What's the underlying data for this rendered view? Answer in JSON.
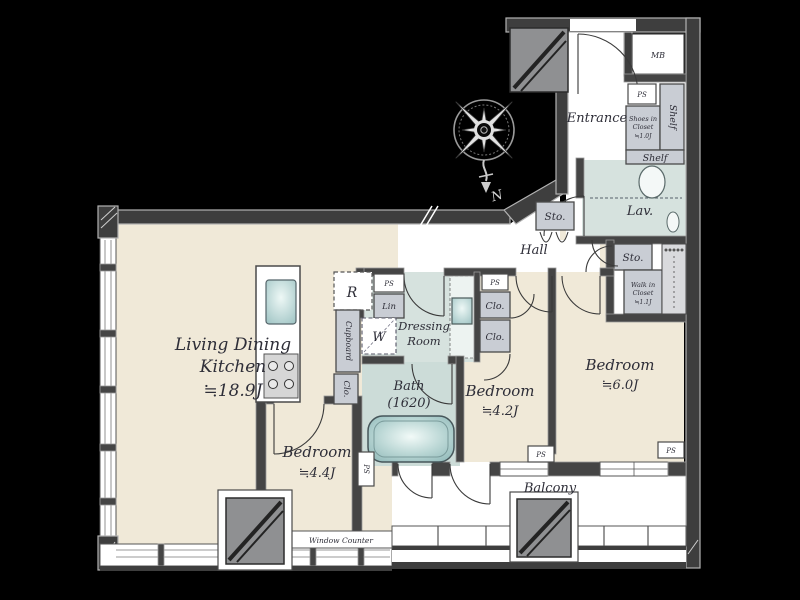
{
  "plan": {
    "title": "apartment-floor-plan",
    "rooms": {
      "ldk": {
        "line1": "Living Dining",
        "line2": "Kitchen",
        "size": "≒18.9J"
      },
      "bedroom_small": {
        "name": "Bedroom",
        "size": "≒4.4J"
      },
      "bedroom_mid": {
        "name": "Bedroom",
        "size": "≒4.2J"
      },
      "bedroom_large": {
        "name": "Bedroom",
        "size": "≒6.0J"
      },
      "bath": {
        "name": "Bath",
        "size": "(1620)"
      },
      "dressing_room": {
        "line1": "Dressing",
        "line2": "Room"
      },
      "entrance": {
        "name": "Entrance"
      },
      "hall": {
        "name": "Hall"
      },
      "lavatory": {
        "name": "Lav."
      },
      "balcony": {
        "name": "Balcony"
      }
    },
    "storage": {
      "shoes_closet": {
        "line1": "Shoes in",
        "line2": "Closet",
        "line3": "≒1.0J"
      },
      "walk_in_closet": {
        "line1": "Walk in",
        "line2": "Closet",
        "line3": "≒1.1J"
      },
      "shelf_right": "Shelf",
      "shelf_lower": "Shelf",
      "storage_hall": "Sto.",
      "storage_right": "Sto.",
      "linen": "Lin",
      "cupboard": "Cupboard",
      "closet_kitchen": "Clo.",
      "closet_b2_upper": "Clo.",
      "closet_b2_lower": "Clo."
    },
    "fixtures": {
      "meter_box": "MB",
      "pipe_space": "PS",
      "refrigerator": "R",
      "washer": "W",
      "window_counter": "Window Counter",
      "compass_north": "N"
    },
    "colors": {
      "background": "#000000",
      "floor": "#f0e9d8",
      "wet_area": "#d6e2de",
      "bath_floor": "#ccdcd8",
      "wall_dark": "#3e3e3e",
      "wall_edge": "#b2b2b2",
      "closet_gray": "#c9cdd4",
      "pillar_gray": "#8f9092",
      "tub_teal": "#9cc3c3",
      "text": "#2e2e38"
    }
  }
}
